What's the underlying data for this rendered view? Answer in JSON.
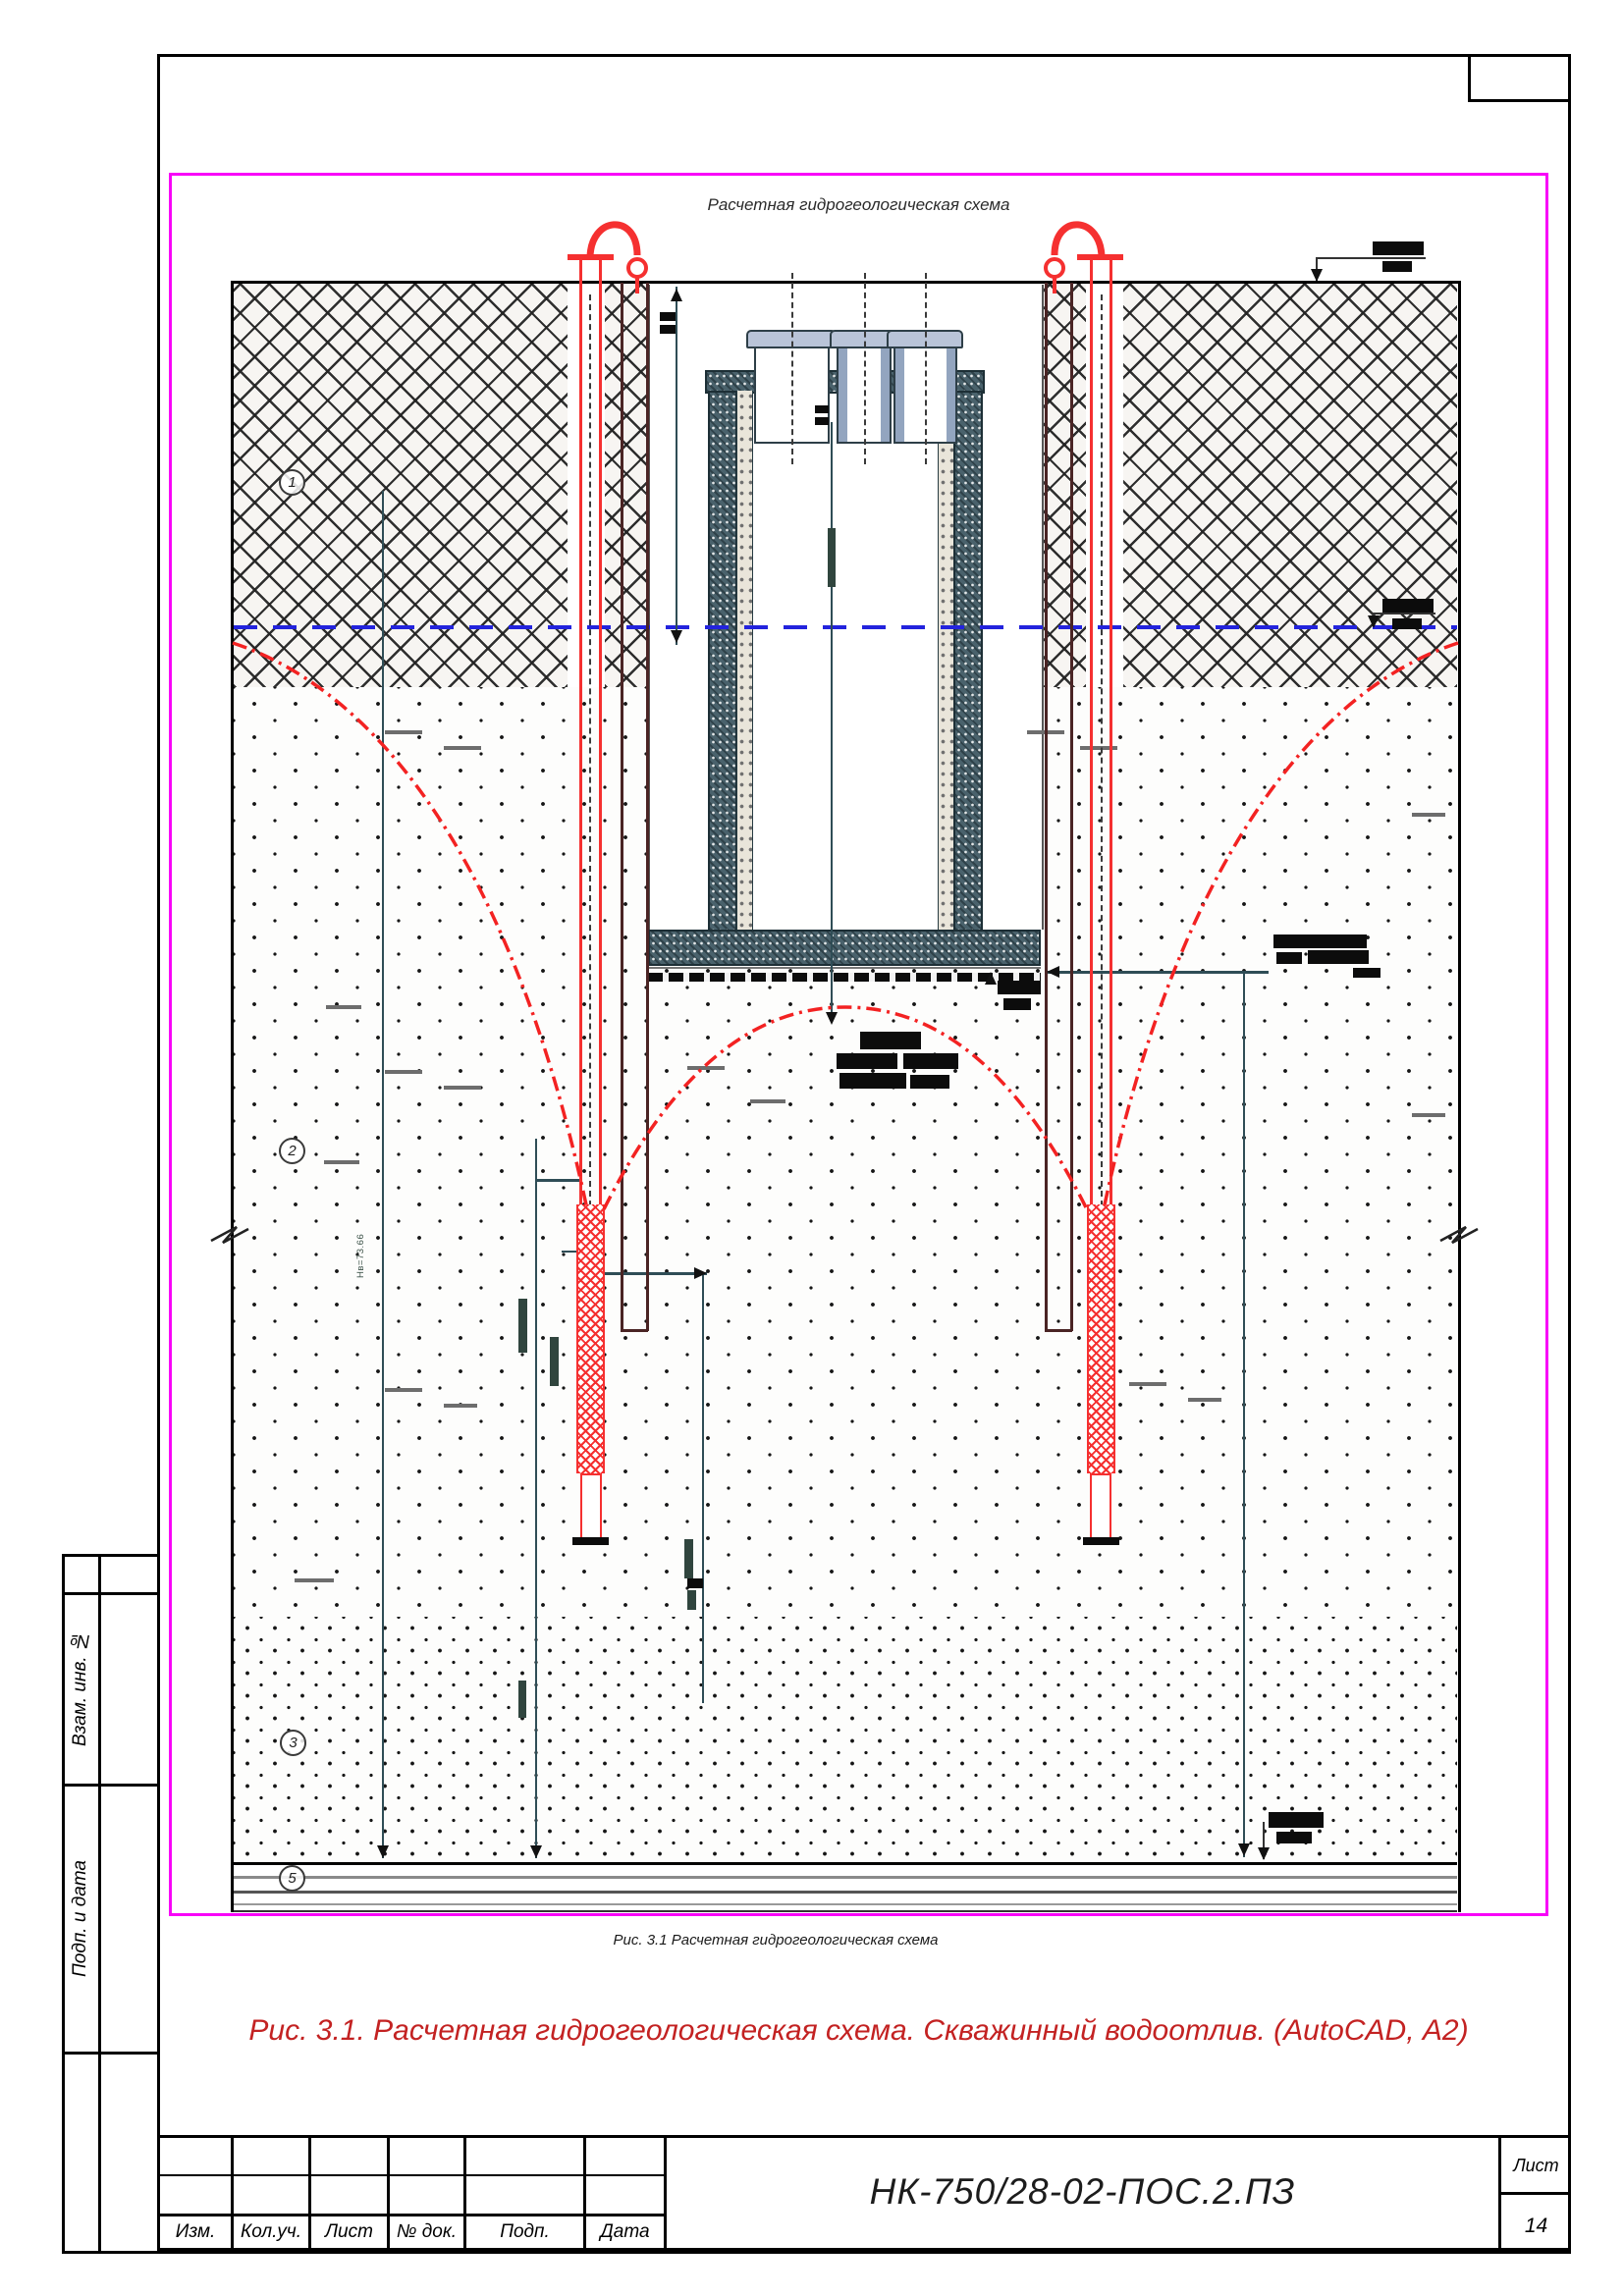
{
  "figure": {
    "title": "Расчетная гидрогеологическая схема",
    "inner_caption": "Рис. 3.1 Расчетная гидрогеологическая схема",
    "caption": "Рис. 3.1. Расчетная гидрогеологическая схема. Скважинный водоотлив. (AutoCAD, А2)",
    "border_color": "#f803f8"
  },
  "layers": [
    {
      "num": "1"
    },
    {
      "num": "2"
    },
    {
      "num": "3"
    },
    {
      "num": "5"
    }
  ],
  "annotations": {
    "hw_label": "Нв=73.66"
  },
  "colors": {
    "well_red": "#f53030",
    "water_blue": "#2323dd",
    "dim_teal": "#2f4d56",
    "casing_brown": "#4a2424",
    "caption_red": "#c32222",
    "figure_border": "#f803f8"
  },
  "sidebar": {
    "items": [
      {
        "label": "Взам. инв. №"
      },
      {
        "label": "Подп. и дата"
      }
    ]
  },
  "titleblock": {
    "columns": [
      {
        "label": "Изм."
      },
      {
        "label": "Кол.уч."
      },
      {
        "label": "Лист"
      },
      {
        "label": "№ док."
      },
      {
        "label": "Подп."
      },
      {
        "label": "Дата"
      }
    ],
    "doc_number": "НК-750/28-02-ПОС.2.ПЗ",
    "sheet_label": "Лист",
    "sheet_number": "14"
  }
}
